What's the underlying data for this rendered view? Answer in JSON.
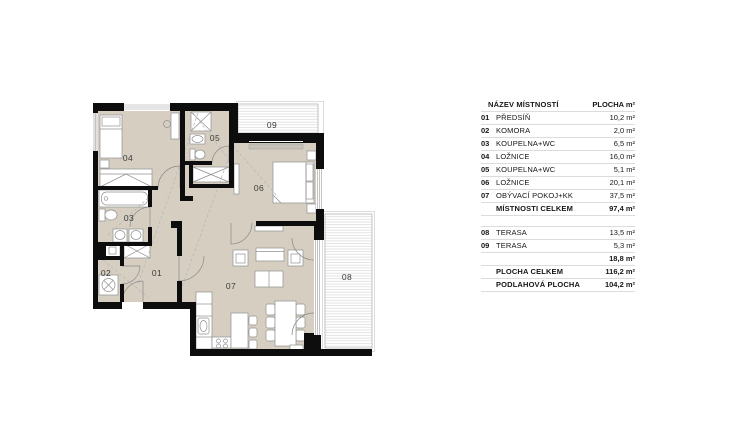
{
  "plan": {
    "labels": {
      "r01": "01",
      "r02": "02",
      "r03": "03",
      "r04": "04",
      "r05": "05",
      "r06": "06",
      "r07": "07",
      "r08": "08",
      "r09": "09"
    },
    "colors": {
      "wall": "#0d0d0d",
      "floor": "#d6cfc1",
      "furniture_stroke": "#909090",
      "deck_stripe": "#d9d9d9",
      "deck_border": "#b5b5b5",
      "label_text": "#3a3a3a"
    }
  },
  "table": {
    "header": {
      "name": "NÁZEV MÍSTNOSTÍ",
      "area": "PLOCHA m²"
    },
    "rooms": [
      {
        "num": "01",
        "name": "PŘEDSÍŇ",
        "area": "10,2 m²"
      },
      {
        "num": "02",
        "name": "KOMORA",
        "area": "2,0 m²"
      },
      {
        "num": "03",
        "name": "KOUPELNA+WC",
        "area": "6,5 m²"
      },
      {
        "num": "04",
        "name": "LOŽNICE",
        "area": "16,0 m²"
      },
      {
        "num": "05",
        "name": "KOUPELNA+WC",
        "area": "5,1 m²"
      },
      {
        "num": "06",
        "name": "LOŽNICE",
        "area": "20,1 m²"
      },
      {
        "num": "07",
        "name": "OBÝVACÍ POKOJ+KK",
        "area": "37,5 m²"
      }
    ],
    "rooms_total": {
      "name": "MÍSTNOSTI CELKEM",
      "area": "97,4 m²"
    },
    "terraces": [
      {
        "num": "08",
        "name": "TERASA",
        "area": "13,5 m²"
      },
      {
        "num": "09",
        "name": "TERASA",
        "area": "5,3 m²"
      }
    ],
    "terraces_total": {
      "name": "",
      "area": "18,8 m²"
    },
    "total": {
      "name": "PLOCHA CELKEM",
      "area": "116,2 m²"
    },
    "floor_total": {
      "name": "PODLAHOVÁ PLOCHA",
      "area": "104,2 m²"
    }
  }
}
